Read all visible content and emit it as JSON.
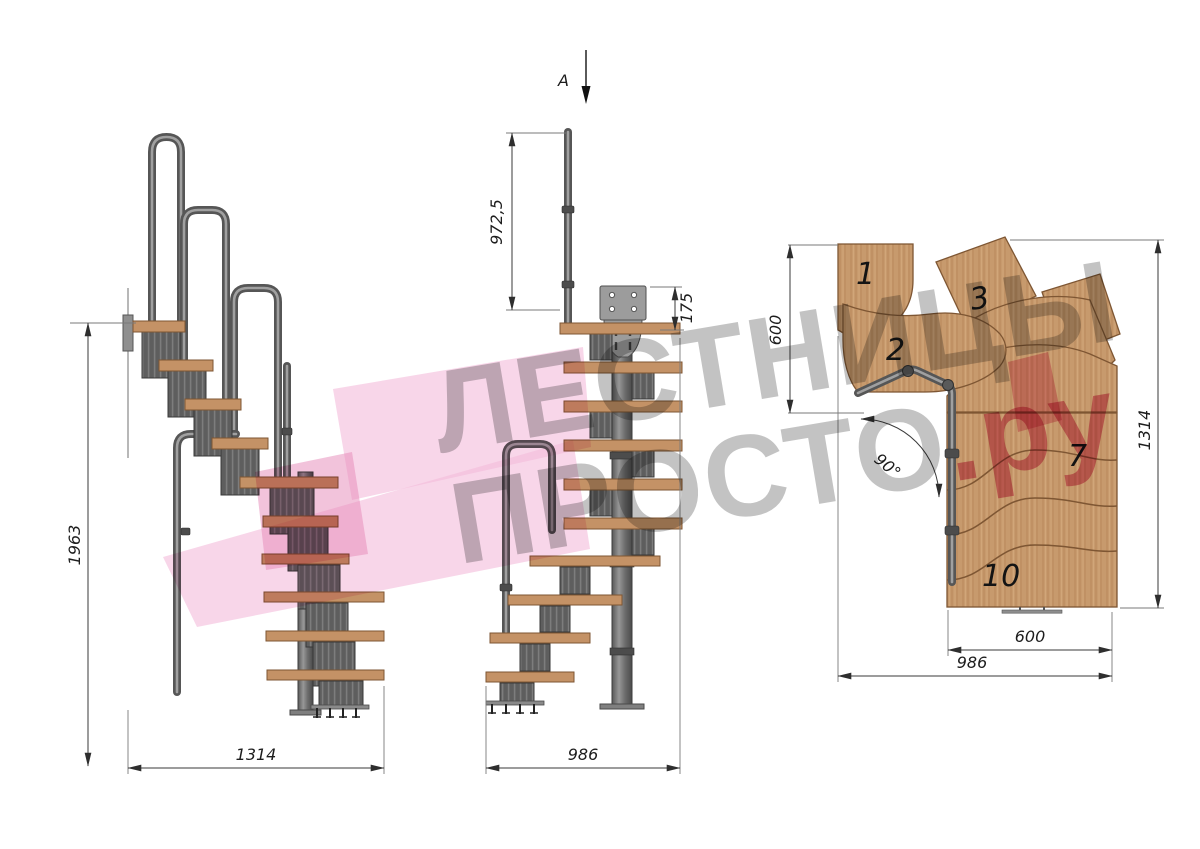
{
  "section_marker": {
    "label": "A"
  },
  "watermark": {
    "line1": "ЛЕСТНИЦЫ",
    "line2": "ПРОСТО",
    "line2_suffix": ".ру",
    "gray": "#8c8c8c",
    "pink": "#d8517f"
  },
  "side_view": {
    "height_dim": "1963",
    "width_dim": "1314"
  },
  "front_view": {
    "rail_height_dim": "972,5",
    "plate_offset_dim": "175",
    "width_dim": "986"
  },
  "plan_view": {
    "upper_run_depth_dim": "600",
    "total_depth_dim": "1314",
    "lower_run_width_dim": "600",
    "total_width_dim": "986",
    "turn_angle": "90°",
    "steps": [
      {
        "number": "1"
      },
      {
        "number": "2"
      },
      {
        "number": "3"
      },
      {
        "number": "7"
      },
      {
        "number": "10"
      }
    ]
  },
  "colors": {
    "wood": "#c49266",
    "metal": "#6f6f6f",
    "module": "#5e5e5e",
    "dim_line": "#3a3a3a",
    "watermark_gray": "#8c8c8c",
    "watermark_pink": "#d8517f",
    "logo_pink": "#f3bada"
  }
}
